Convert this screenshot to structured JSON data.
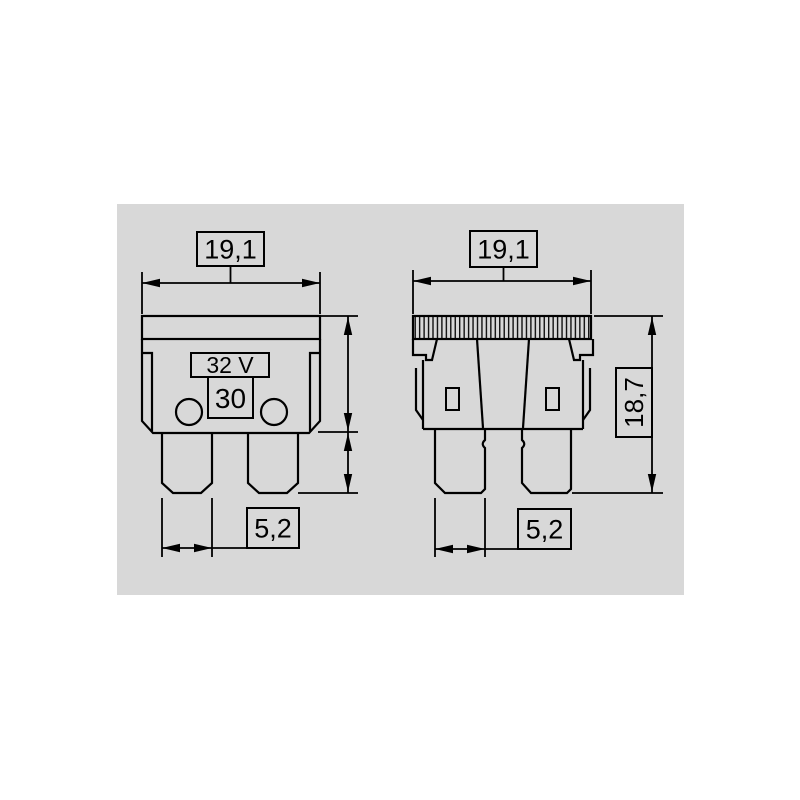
{
  "colors": {
    "page_background": "#ffffff",
    "panel_background": "#d8d8d8",
    "line": "#000000",
    "text": "#000000"
  },
  "front_view": {
    "width_dim": "19,1",
    "blade_width_dim": "5,2",
    "voltage_rating": "32 V",
    "current_rating": "30"
  },
  "rear_view": {
    "width_dim": "19,1",
    "blade_width_dim": "5,2",
    "height_dim": "18,7"
  }
}
